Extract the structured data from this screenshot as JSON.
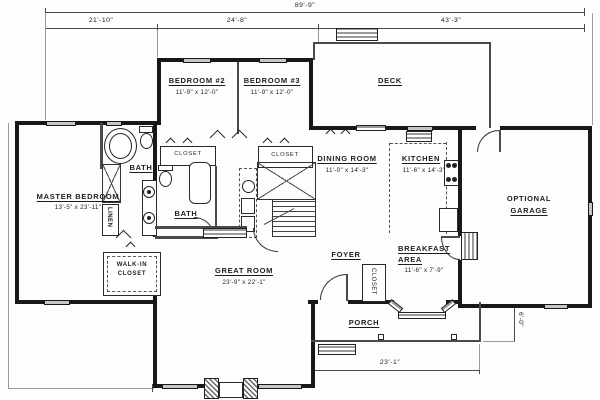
{
  "dims": {
    "overall": "89'-9\"",
    "left": "21'-10\"",
    "middle": "24'-8\"",
    "right": "43'-3\"",
    "porch_width": "23'-1\"",
    "porch_depth": "6'-0\""
  },
  "rooms": {
    "master_bedroom": {
      "name": "MASTER BEDROOM",
      "size": "13'-5\" x 23'-11\""
    },
    "bedroom_2": {
      "name": "BEDROOM #2",
      "size": "11'-9\" x 12'-0\""
    },
    "bedroom_3": {
      "name": "BEDROOM #3",
      "size": "11'-9\" x 12'-0\""
    },
    "deck": {
      "name": "DECK"
    },
    "dining_room": {
      "name": "DINING ROOM",
      "size": "11'-0\" x 14'-3\""
    },
    "kitchen": {
      "name": "KITCHEN",
      "size": "11'-6\" x 14'-3\""
    },
    "garage": {
      "name1": "OPTIONAL",
      "name2": "GARAGE"
    },
    "great_room": {
      "name": "GREAT ROOM",
      "size": "23'-9\" x 22'-1\""
    },
    "foyer": {
      "name": "FOYER"
    },
    "breakfast_area": {
      "name1": "BREAKFAST",
      "name2": "AREA",
      "size": "11'-6\" x 7'-9\""
    },
    "porch": {
      "name": "PORCH"
    },
    "master_bath": {
      "name": "BATH"
    },
    "hall_bath": {
      "name": "BATH"
    },
    "closet_bed2": {
      "name": "CLOSET"
    },
    "closet_bed3": {
      "name": "CLOSET"
    },
    "foyer_closet": {
      "name": "CLOSET"
    },
    "walk_in_closet": {
      "name1": "WALK-IN",
      "name2": "CLOSET"
    },
    "linen": {
      "name": "LINEN"
    }
  },
  "colors": {
    "wall": "#181818",
    "thin_line": "#4a4a4a",
    "window_fill": "#c6c6c6",
    "paper": "#fdfdfb"
  }
}
